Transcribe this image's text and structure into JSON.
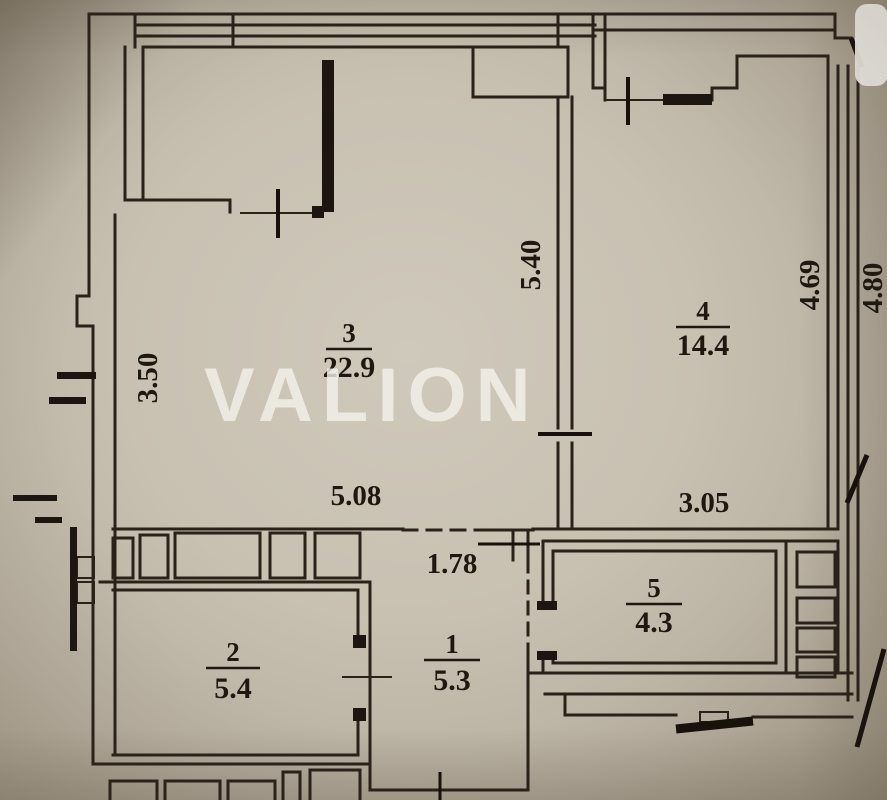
{
  "watermark": {
    "text": "VALION"
  },
  "rooms": [
    {
      "number": "3",
      "area": "22.9"
    },
    {
      "number": "4",
      "area": "14.4"
    },
    {
      "number": "5",
      "area": "4.3"
    },
    {
      "number": "1",
      "area": "5.3"
    },
    {
      "number": "2",
      "area": "5.4"
    }
  ],
  "dimensions": {
    "room3_left_height": "3.50",
    "room3_inner_height": "5.40",
    "room3_width": "5.08",
    "hall_opening_width": "1.78",
    "room4_width": "3.05",
    "room4_inner_height": "4.69",
    "room4_outer_height": "4.80"
  },
  "colors": {
    "paper": "#c8c1b2",
    "line": "#2a2119",
    "watermark_text": "#f3f1ea"
  }
}
